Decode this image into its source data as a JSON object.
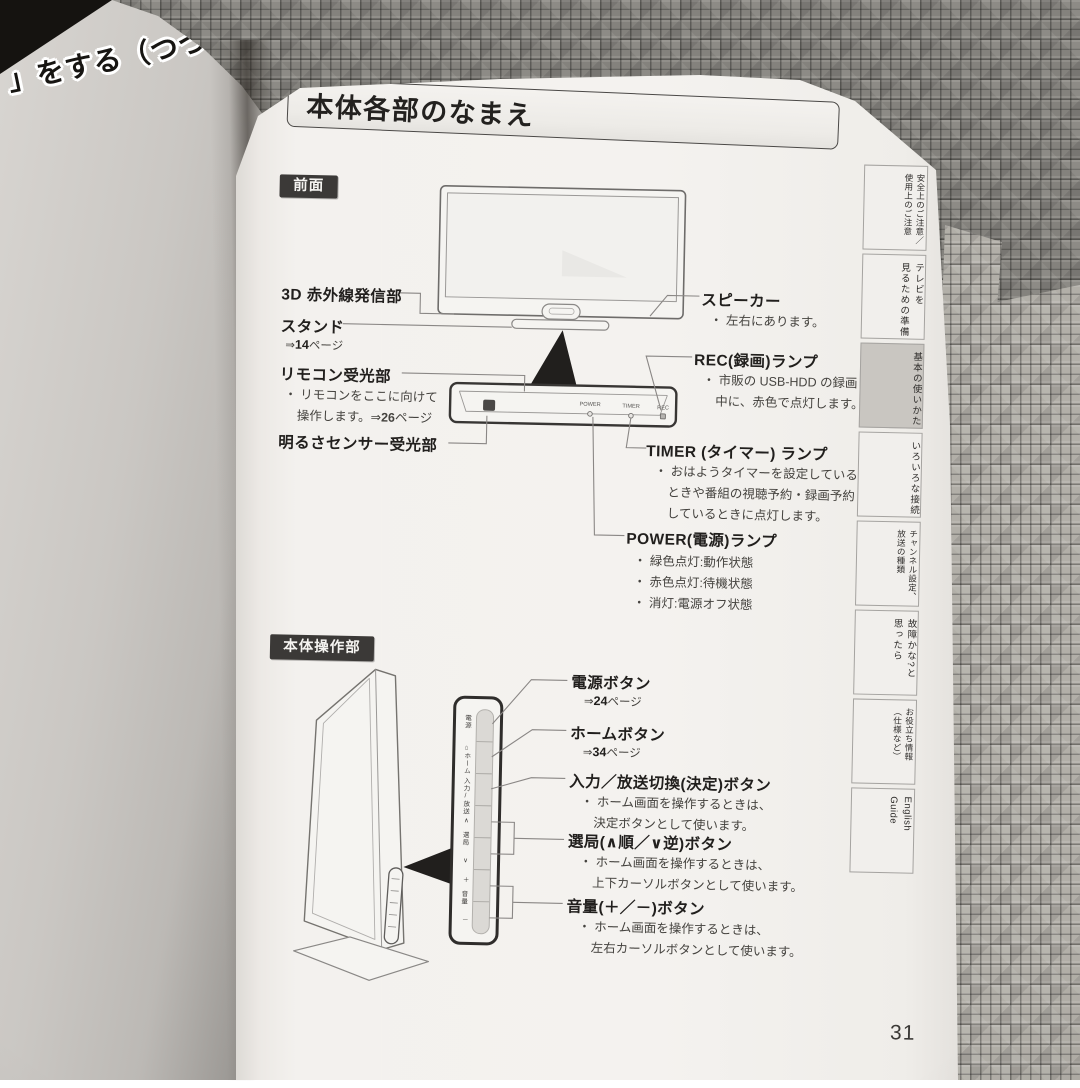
{
  "colors": {
    "tag_bg": "#3b3937",
    "tab_active_bg": "#c9c6c1"
  },
  "prev_page": {
    "header_fragment": "」をする（つづき）"
  },
  "page": {
    "title": "本体各部のなまえ",
    "number": "31"
  },
  "front": {
    "tag": "前面",
    "panel": {
      "power": "POWER",
      "timer": "TIMER",
      "rec": "REC"
    },
    "left_labels": [
      {
        "title": "3D 赤外線発信部"
      },
      {
        "title": "スタンド",
        "ref_pre": "⇒",
        "ref_num": "14",
        "ref_suf": "ページ"
      },
      {
        "title": "リモコン受光部",
        "line1": "・ リモコンをここに向けて",
        "line2_pre": "操作します。⇒",
        "line2_num": "26",
        "line2_suf": "ページ"
      },
      {
        "title": "明るさセンサー受光部"
      }
    ],
    "right_labels": [
      {
        "title": "スピーカー",
        "lines": [
          "・ 左右にあります。"
        ]
      },
      {
        "title": "REC(録画)ランプ",
        "lines": [
          "・ 市販の USB-HDD の録画",
          "中に、赤色で点灯します。"
        ]
      },
      {
        "title": "TIMER (タイマー) ランプ",
        "lines": [
          "・ おはようタイマーを設定している",
          "ときや番組の視聴予約・録画予約",
          "しているときに点灯します。"
        ]
      },
      {
        "title": "POWER(電源)ランプ",
        "lines": [
          "・ 緑色点灯:動作状態",
          "・ 赤色点灯:待機状態",
          "・ 消灯:電源オフ状態"
        ]
      }
    ]
  },
  "controls": {
    "tag": "本体操作部",
    "strip": {
      "power": "電源",
      "home": "⌂ホーム",
      "input": "入力/放送",
      "ch_up": "∧",
      "ch": "選局",
      "ch_down": "∨",
      "vol_up": "＋",
      "vol": "音量",
      "vol_down": "－"
    },
    "labels": [
      {
        "title": "電源ボタン",
        "ref_pre": "⇒",
        "ref_num": "24",
        "ref_suf": "ページ"
      },
      {
        "title": "ホームボタン",
        "ref_pre": "⇒",
        "ref_num": "34",
        "ref_suf": "ページ"
      },
      {
        "title": "入力／放送切換(決定)ボタン",
        "lines": [
          "・ ホーム画面を操作するときは、",
          "決定ボタンとして使います。"
        ]
      },
      {
        "title": "選局(∧順／∨逆)ボタン",
        "lines": [
          "・ ホーム画面を操作するときは、",
          "上下カーソルボタンとして使います。"
        ]
      },
      {
        "title": "音量(＋／－)ボタン",
        "lines": [
          "・ ホーム画面を操作するときは、",
          "左右カーソルボタンとして使います。"
        ]
      }
    ]
  },
  "tabs": [
    {
      "label": "安全上のご注意／\n使用上のご注意",
      "active": false
    },
    {
      "label": "テレビを\n見るための準備",
      "active": false
    },
    {
      "label": "基本の使いかた",
      "active": true
    },
    {
      "label": "いろいろな接続",
      "active": false
    },
    {
      "label": "チャンネル設定、\n放送の種類",
      "active": false
    },
    {
      "label": "故障かな?と\n思ったら",
      "active": false
    },
    {
      "label": "お役立ち情報\n（仕様など）",
      "active": false
    },
    {
      "label": "English\nGuide",
      "active": false
    }
  ]
}
